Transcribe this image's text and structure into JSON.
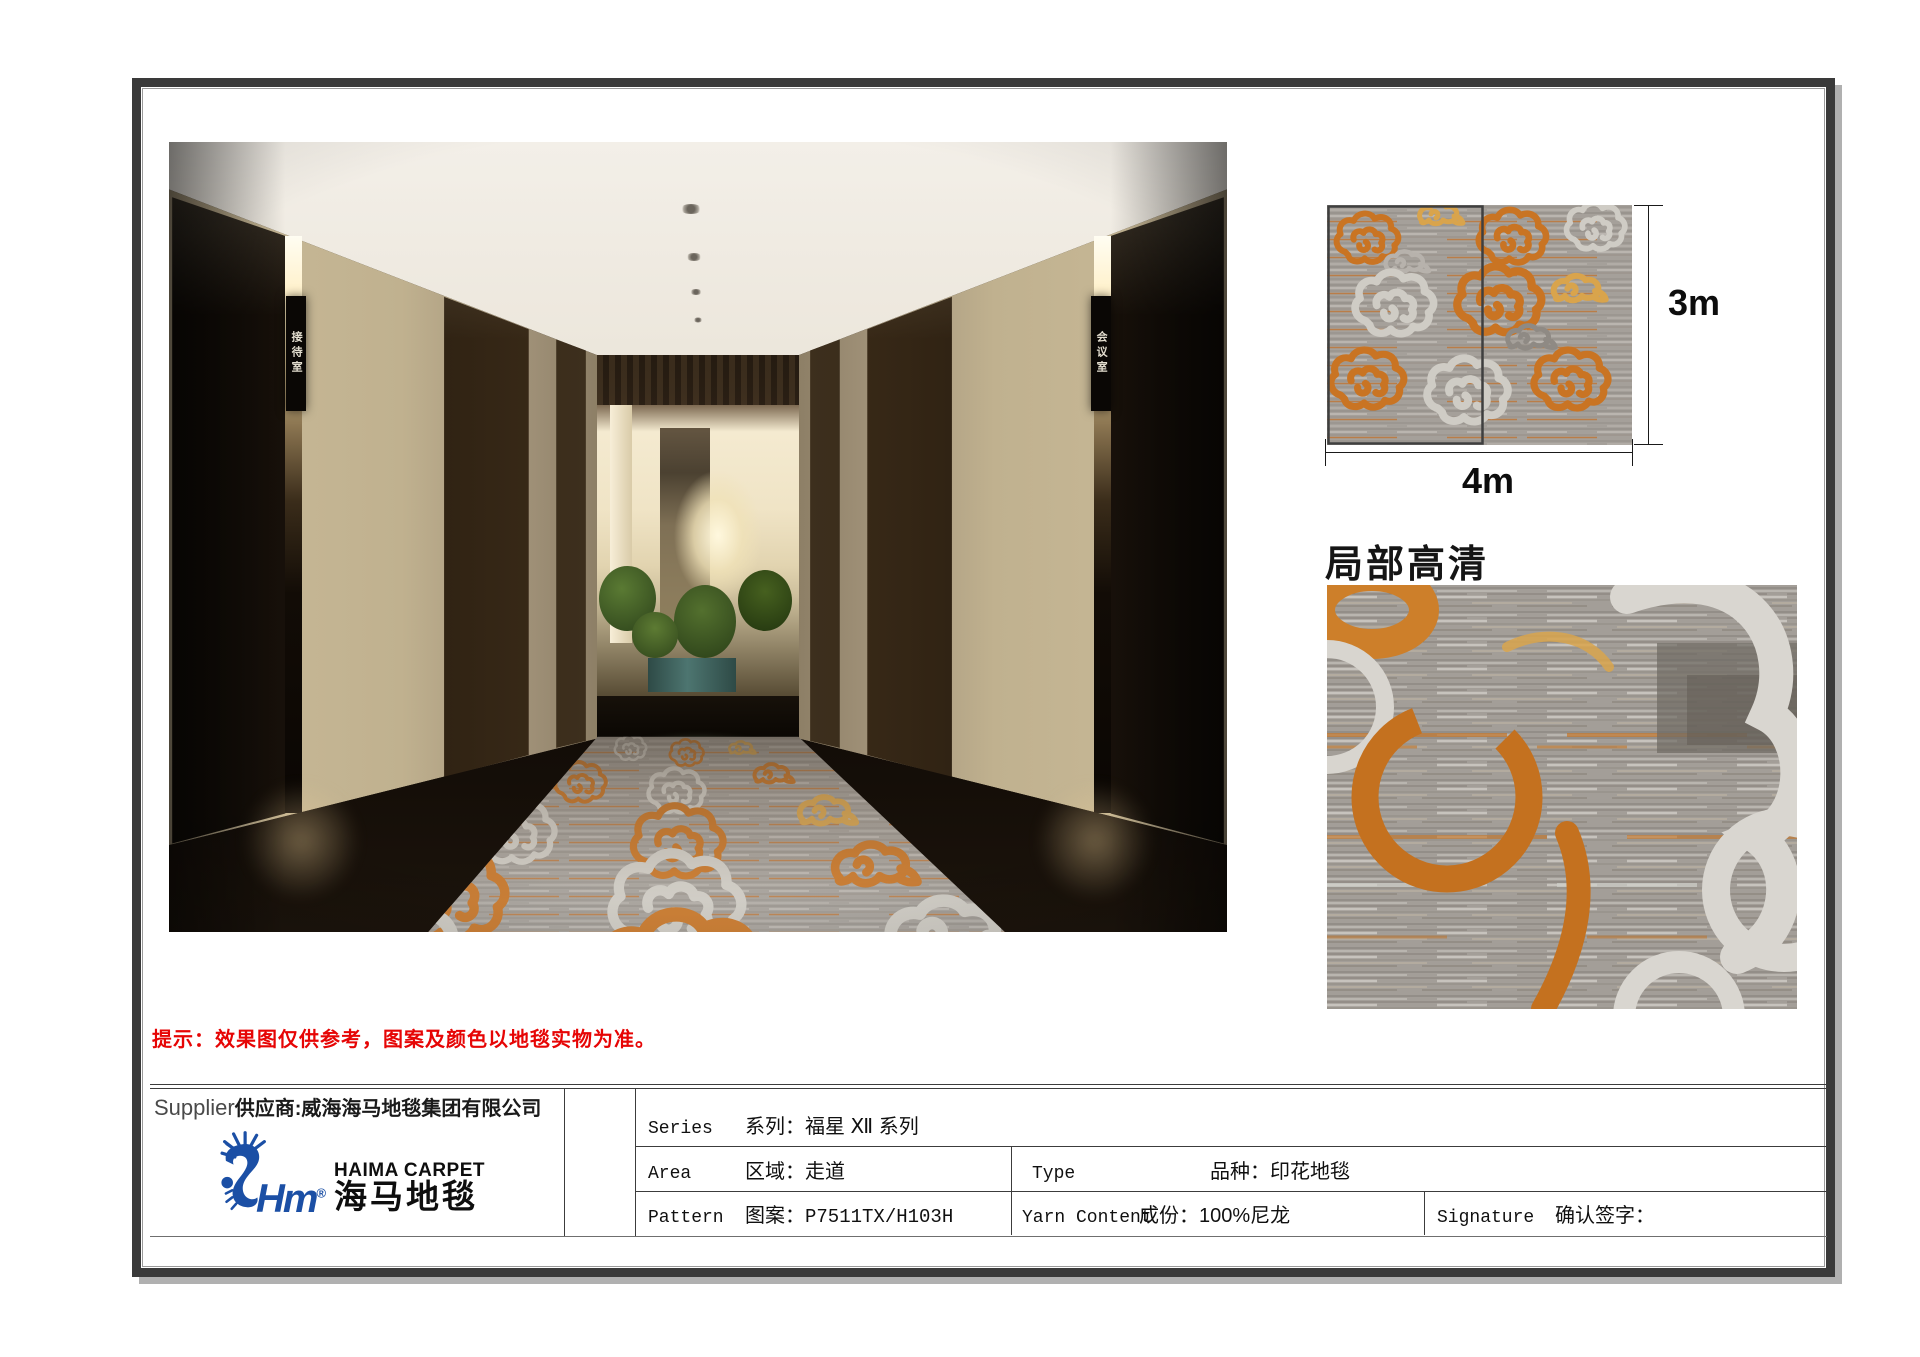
{
  "notice": "提示：效果图仅供参考，图案及颜色以地毯实物为准。",
  "dimensions": {
    "height_label": "3m",
    "width_label": "4m"
  },
  "detail": {
    "title": "局部高清"
  },
  "corridor": {
    "left_door_sign": "接待室",
    "right_door_sign": "会议室"
  },
  "supplier": {
    "label_en": "Supplier",
    "label_zh": "供应商:",
    "name": "威海海马地毯集团有限公司"
  },
  "logo": {
    "monogram": "Hm",
    "registered": "®",
    "brand_en": "HAIMA CARPET",
    "brand_zh": "海马地毯"
  },
  "spec": {
    "series": {
      "label_en": "Series",
      "label_zh": "系列：",
      "value": "福星 Ⅻ 系列"
    },
    "area": {
      "label_en": "Area",
      "label_zh": "区域：",
      "value": "走道"
    },
    "type": {
      "label_en": "Type",
      "label_zh": "品种：",
      "value": "印花地毯"
    },
    "pattern": {
      "label_en": "Pattern",
      "label_zh": "图案：",
      "value": "P7511TX/H103H"
    },
    "yarn": {
      "label_en": "Yarn Content",
      "label_zh": "成份：",
      "value": "100%尼龙"
    },
    "signature": {
      "label_en": "Signature",
      "label_zh": "确认签字：",
      "value": ""
    }
  },
  "colors": {
    "carpet_orange": "#c97423",
    "carpet_gold": "#d9a44c",
    "carpet_cream": "#cfccc5",
    "carpet_gray": "#a5a09a",
    "logo_blue": "#1b4fa5",
    "notice_red": "#e60505",
    "frame_dark": "#3a3a3a"
  }
}
